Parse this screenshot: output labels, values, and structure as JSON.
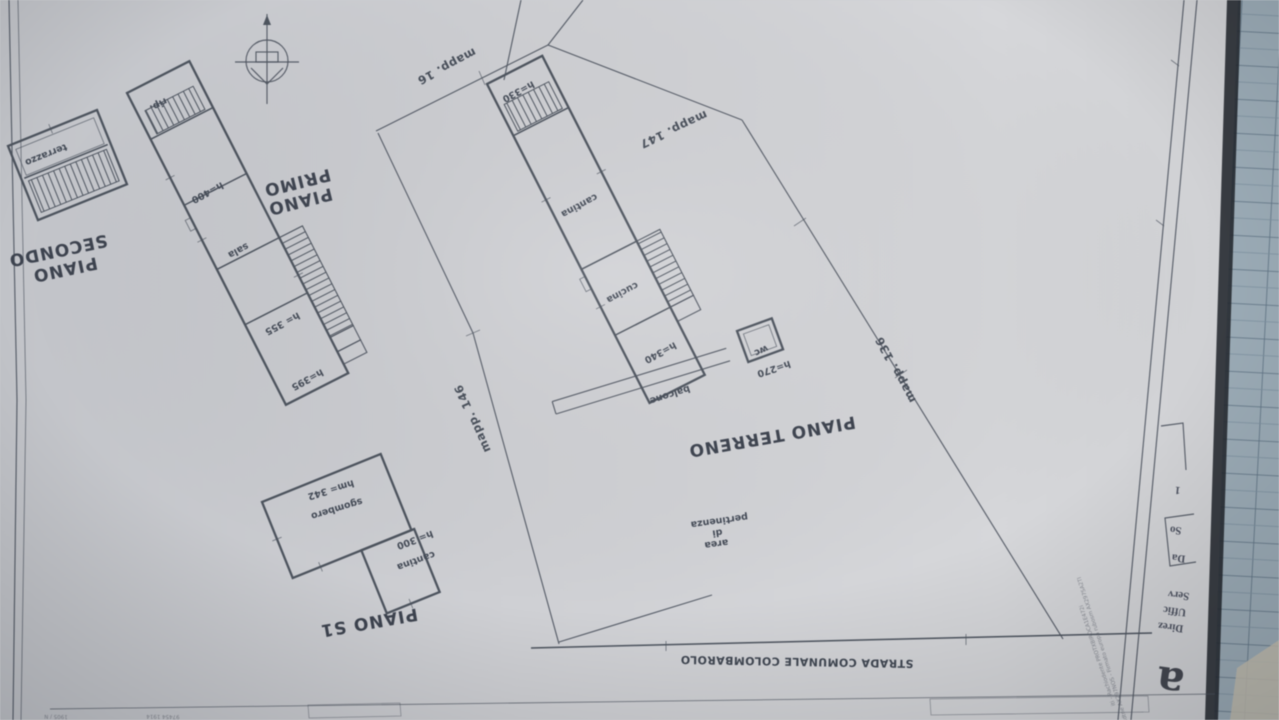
{
  "floor_plans": {
    "piano_secondo": {
      "title_line1": "PIANO",
      "title_line2": "SECONDO",
      "rooms": {
        "terrazzo": "terrazzo"
      }
    },
    "piano_primo": {
      "title_line1": "PIANO",
      "title_line2": "PRIMO",
      "rooms": {
        "rip": "rip.",
        "h400": "h=400",
        "sala": "sala",
        "h355": "h= 355",
        "h395": "h=395"
      }
    },
    "piano_terreno": {
      "title": "PIANO TERRENO",
      "rooms": {
        "h330": "h=330",
        "cantina": "cantina",
        "cucina": "cucina",
        "h340": "h=340",
        "balcone": "balcone",
        "wc": "wc",
        "h270": "h=270"
      }
    },
    "piano_s1": {
      "title": "PIANO S1",
      "rooms": {
        "sgombero": "sgombero",
        "sgombero_h": "hm= 342",
        "cantina": "cantina",
        "cantina_h": "h= 300"
      }
    }
  },
  "site": {
    "parcels": {
      "mapp_16": "mapp. 16",
      "mapp_147": "mapp. 147",
      "mapp_146": "mapp. 146",
      "mapp_136": "mapp. 136"
    },
    "area_label": {
      "line1": "area",
      "line2": "di",
      "line3": "pertinenza"
    },
    "road_name": "STRADA COMUNALE COLOMBAROLO"
  },
  "title_block": {
    "stamp": {
      "line1": "Direz",
      "line2": "Uffic",
      "line3": "Serv",
      "logo_glyph": "a"
    },
    "box": {
      "line1": "Da",
      "line2": "So"
    },
    "sheet_mark": "1",
    "microtext_side_1": "iti - Rachiodente PROTXBIROCA1E472i",
    "microtext_side_2": "di spedidtne AX297NOS - Firmato europa rubosm AX297SA2TI",
    "bottom_fragments": {
      "f1": "1905 / N",
      "f2": "97454 1914"
    }
  },
  "colors": {
    "paper": "#cdced2",
    "ink": "#4d545f",
    "text": "#3d4350",
    "table_surface": "#9aabb7",
    "table_grid": "#5d7284",
    "edge_shadow": "#22272e"
  }
}
